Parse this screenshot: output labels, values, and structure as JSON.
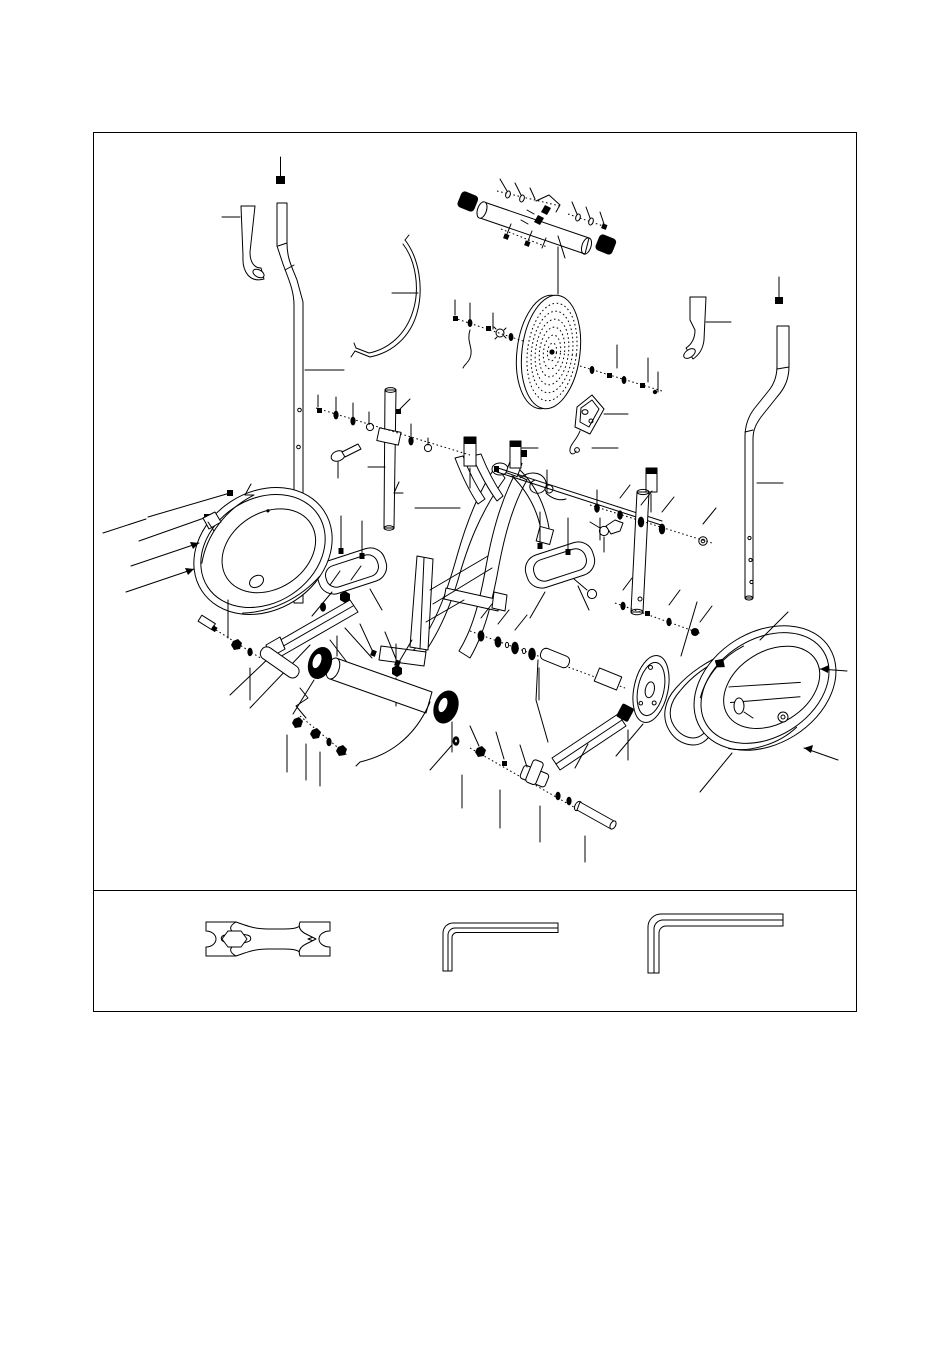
{
  "document": {
    "kind": "exploded-parts-diagram-page",
    "background": "#ffffff",
    "ink": "#000000",
    "page_border": {
      "x": 93,
      "y": 132,
      "width": 764,
      "height": 880
    },
    "tool_strip_divider_y": 890
  },
  "diagram": {
    "type": "exploded-view-line-drawing",
    "parts": [
      "left-handlebar-small-tube",
      "left-upright-tube",
      "top-handlebar-assembly",
      "idler-strap-arc",
      "perforated-flywheel",
      "sensor-bracket-with-wire",
      "right-rear-bent-tube",
      "right-upright-tube",
      "main-frame",
      "left-swing-post",
      "connecting-rod",
      "right-swing-link",
      "left-pedal",
      "right-pedal",
      "left-chain-cover",
      "right-chain-cover",
      "left-pedal-bar",
      "left-crank-arm",
      "front-roller-tube",
      "crank-washer-chain",
      "drive-pulley",
      "drive-belt",
      "bottom-axle-bolt-chain",
      "assorted-fasteners"
    ],
    "tools": [
      "double-open-end-wrench-with-hex",
      "allen-key-small",
      "allen-key-large"
    ]
  }
}
